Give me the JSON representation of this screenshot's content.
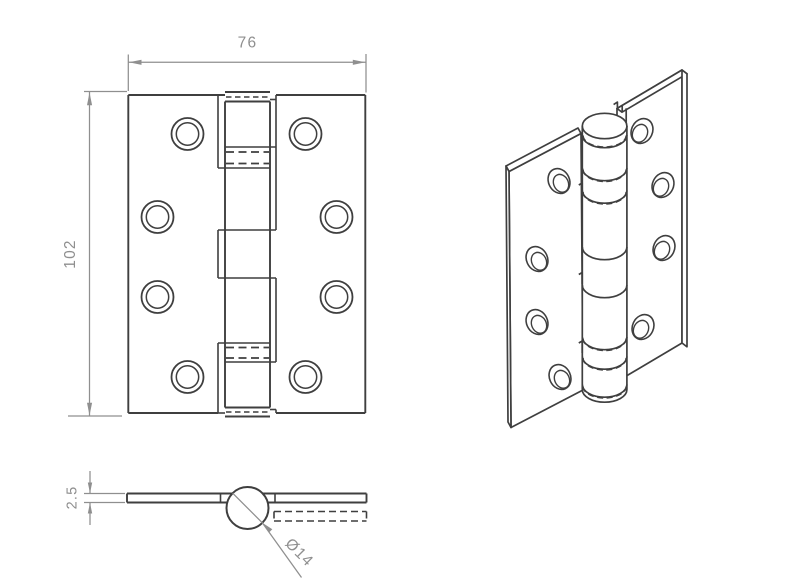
{
  "dims": {
    "width": "76",
    "height": "102",
    "thickness": "2.5",
    "knuckle_diameter": "Ø14"
  },
  "colors": {
    "background": "#ffffff",
    "outline": "#3f3f3f",
    "dimension": "#8f8f8f"
  }
}
